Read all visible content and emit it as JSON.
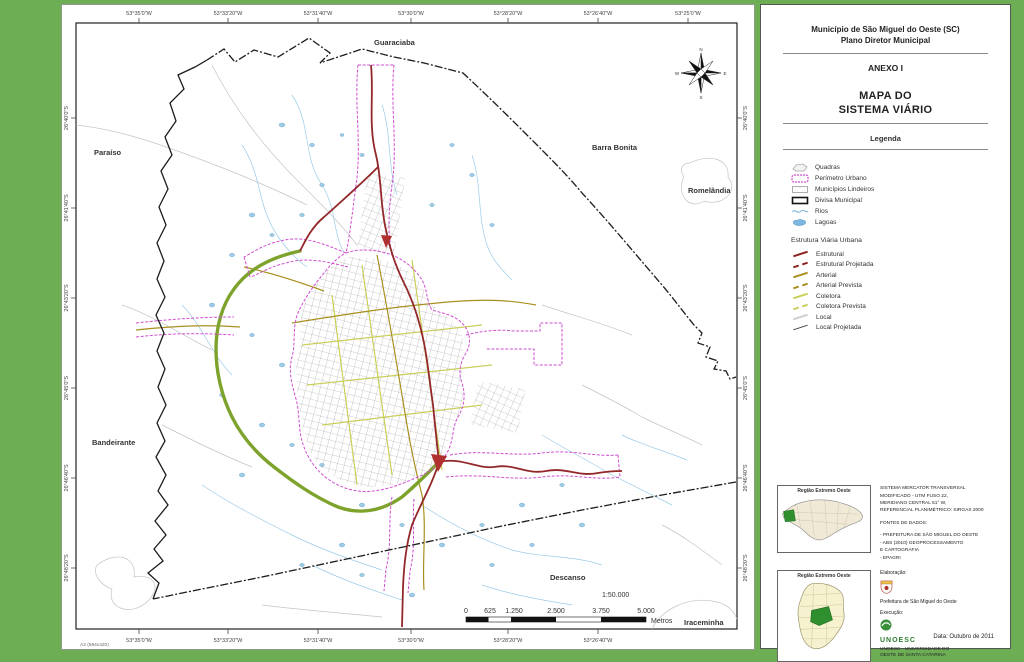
{
  "colors": {
    "background": "#6dae55",
    "estrutural": "#8e2323",
    "arterial": "#a8901f",
    "coletora": "#c9cf58",
    "local": "#cfcfcf",
    "perimetro_urbano": "#cf4fcf",
    "rios": "#9ccbe8",
    "divisa_municipal": "#1c1c1c",
    "coletora_verde": "#7da32c"
  },
  "map": {
    "corner_label": "A2 (594x420)",
    "scale_text": "1:50.000",
    "scale_labels": [
      "0",
      "625",
      "1.250",
      "2.500",
      "3.750",
      "5.000"
    ],
    "scale_unit": "Metros",
    "compass": {
      "n": "N",
      "s": "S",
      "e": "E",
      "w": "W"
    },
    "neighbors": [
      "Guaraciaba",
      "Paraíso",
      "Barra Bonita",
      "Romelândia",
      "Bandeirante",
      "Descanso",
      "Iraceminha"
    ],
    "top_coords": [
      "53°35'0\"W",
      "53°33'20\"W",
      "53°31'40\"W",
      "53°30'0\"W",
      "53°28'20\"W",
      "53°26'40\"W",
      "53°25'0\"W"
    ],
    "left_coords": [
      "26°40'0\"S",
      "26°41'40\"S",
      "26°43'20\"S",
      "26°45'0\"S",
      "26°46'40\"S",
      "26°48'20\"S"
    ]
  },
  "panel": {
    "title_line1": "Município de São Miguel do Oeste (SC)",
    "title_line2": "Plano Diretor Municipal",
    "anexo": "ANEXO I",
    "map_title_line1": "MAPA DO",
    "map_title_line2": "SISTEMA VIÁRIO",
    "legend_title": "Legenda",
    "legend_items": [
      {
        "label": "Quadras"
      },
      {
        "label": "Perímetro Urbano"
      },
      {
        "label": "Municípios Lindeiros"
      },
      {
        "label": "Divisa Municipal"
      },
      {
        "label": "Rios"
      },
      {
        "label": "Lagoas"
      }
    ],
    "road_legend_title": "Estrutura Viária Urbana",
    "road_items": [
      {
        "label": "Estrutural"
      },
      {
        "label": "Estrutural Projetada"
      },
      {
        "label": "Arterial"
      },
      {
        "label": "Arterial Prevista"
      },
      {
        "label": "Coletora"
      },
      {
        "label": "Coletora Prevista"
      },
      {
        "label": "Local"
      },
      {
        "label": "Local Projetada"
      }
    ],
    "inset1_title": "Região Extremo Oeste",
    "inset2_title": "Região Extremo Oeste",
    "projection_lines": [
      "SISTEMA MERCATOR TRANSVERSAL",
      "MODIFICADO - UTM FUSO 22,",
      "MERIDIANO CENTRAL 51° W,",
      "REFERENCIAL PLANIMÉTRICO: SIRGAS 2000"
    ],
    "fontes_title": "FONTES DE DADOS:",
    "fontes_lines": [
      "- PREFEITURA DE SÃO MIGUEL DO OESTE",
      "- ABS (2010) GEOPROCESSAMENTO",
      "  E CARTOGRAFIA",
      "- EPAGRI"
    ],
    "elaboracao_label": "Elaboração:",
    "elaboracao_name": "Prefeitura de São Miguel do Oeste",
    "execucao_label": "Execução:",
    "unoesc_word": "UNOESC",
    "unoesc_name_line1": "UNOESC - UNIVERSIDADE DO",
    "unoesc_name_line2": "OESTE DE SANTA CATARINA",
    "date_label": "Data: Outubro de 2011"
  }
}
